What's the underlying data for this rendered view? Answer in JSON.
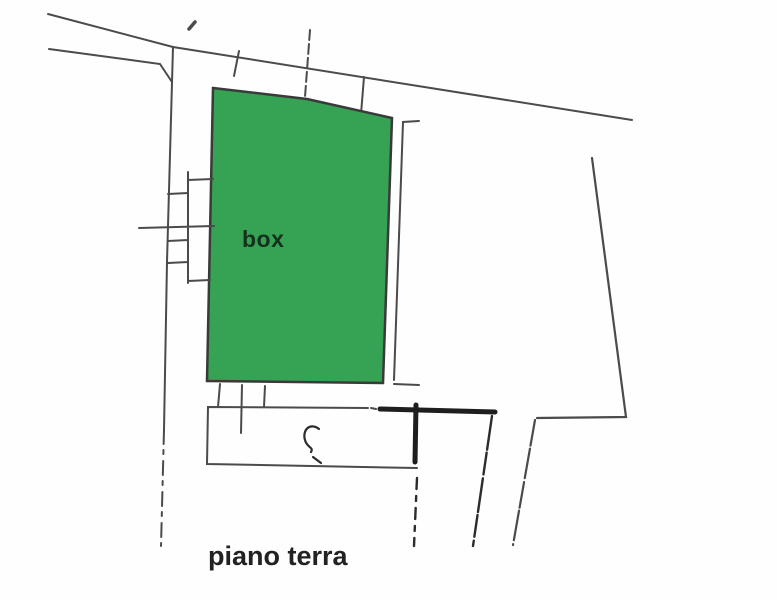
{
  "plan": {
    "room_label": "box",
    "floor_label": "piano terra",
    "colors": {
      "highlight_green": "#35a254",
      "highlight_outline": "#3a3a3a",
      "wall_gray": "#4b4b4b",
      "dark_ink": "#1e1e1e",
      "background": "#fefefe",
      "room_label_color": "#15301c",
      "floor_label_color": "#222222"
    }
  }
}
